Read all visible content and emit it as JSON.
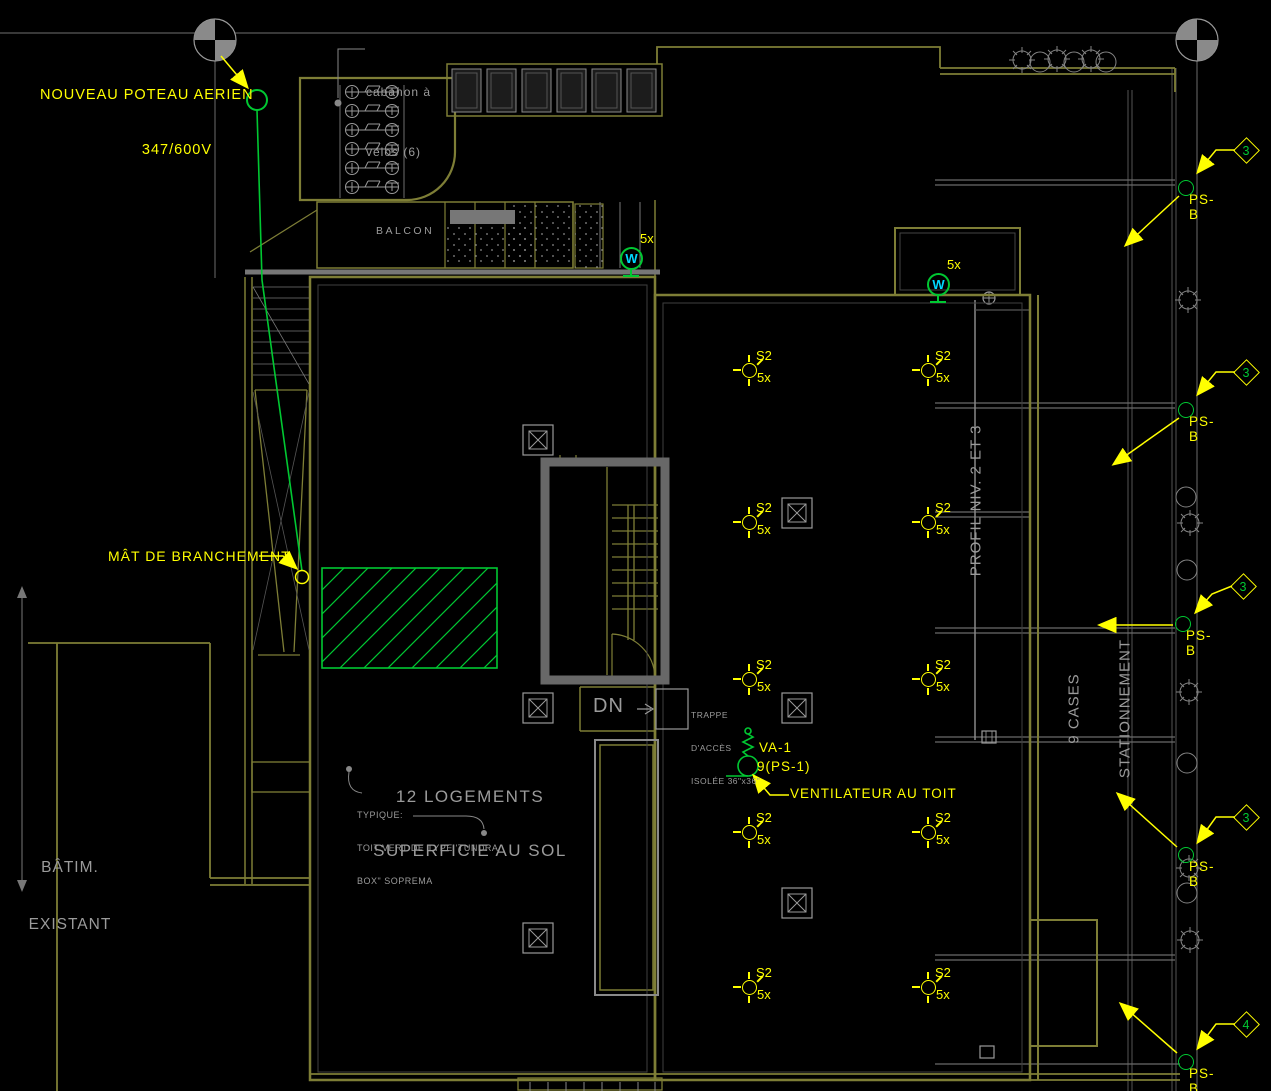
{
  "drawing": {
    "type": "electrical-roof-site-plan",
    "background": "#000000"
  },
  "colors": {
    "building_olive": "#7e7e36",
    "line_gray": "#6a6a6a",
    "text_gray": "#9b9b9b",
    "annotation_yellow": "#ffff00",
    "electrical_green": "#00c832",
    "device_cyan": "#00d8ff",
    "wall_gray": "#686868"
  },
  "annotations": {
    "nouveau_poteau_line1": "NOUVEAU POTEAU AERIEN",
    "nouveau_poteau_line2": "347/600V",
    "cabanon_line1": "cabanon à",
    "cabanon_line2": "vélos (6)",
    "balcon": "BALCON",
    "mat_branchement": "MÂT DE BRANCHEMENT",
    "batim_line1": "BÂTIM.",
    "batim_line2": "EXISTANT",
    "logements_line1": "12 LOGEMENTS",
    "logements_line2": "SUPERFICIE AU SOL",
    "typique_line1": "TYPIQUE:",
    "typique_line2": "TOIT VERT DE TYPE 'TUNDRA",
    "typique_line3": "BOX\" SOPREMA",
    "dn": "DN",
    "trappe_line1": "TRAPPE",
    "trappe_line2": "D'ACCÈS",
    "trappe_line3": "ISOLÉE 36\"x36\"",
    "va1": "VA-1",
    "va1_circuit": "9(PS-1)",
    "ventilateur": "VENTILATEUR AU TOIT",
    "profil": "PROFIL NIV. 2 ET 3",
    "cases_line1": "9 CASES",
    "cases_line2": "STATIONNEMENT"
  },
  "symbols": {
    "s2_label": "S2",
    "s2_count": "5x",
    "s2": [
      {
        "x": 750,
        "y": 371
      },
      {
        "x": 929,
        "y": 371
      },
      {
        "x": 750,
        "y": 523
      },
      {
        "x": 929,
        "y": 523
      },
      {
        "x": 750,
        "y": 680
      },
      {
        "x": 929,
        "y": 680
      },
      {
        "x": 750,
        "y": 833
      },
      {
        "x": 929,
        "y": 833
      },
      {
        "x": 750,
        "y": 988
      },
      {
        "x": 929,
        "y": 988
      }
    ],
    "w_letter": "W",
    "w_count": "5x",
    "w": [
      {
        "x": 631,
        "y": 258
      },
      {
        "x": 938,
        "y": 284
      }
    ],
    "psb_label": "PS-B",
    "psb": [
      {
        "x": 1186,
        "y": 188,
        "num": "3"
      },
      {
        "x": 1186,
        "y": 410,
        "num": "3"
      },
      {
        "x": 1183,
        "y": 624,
        "num": "3"
      },
      {
        "x": 1186,
        "y": 855,
        "num": "3"
      },
      {
        "x": 1186,
        "y": 1062,
        "num": "4"
      }
    ]
  }
}
